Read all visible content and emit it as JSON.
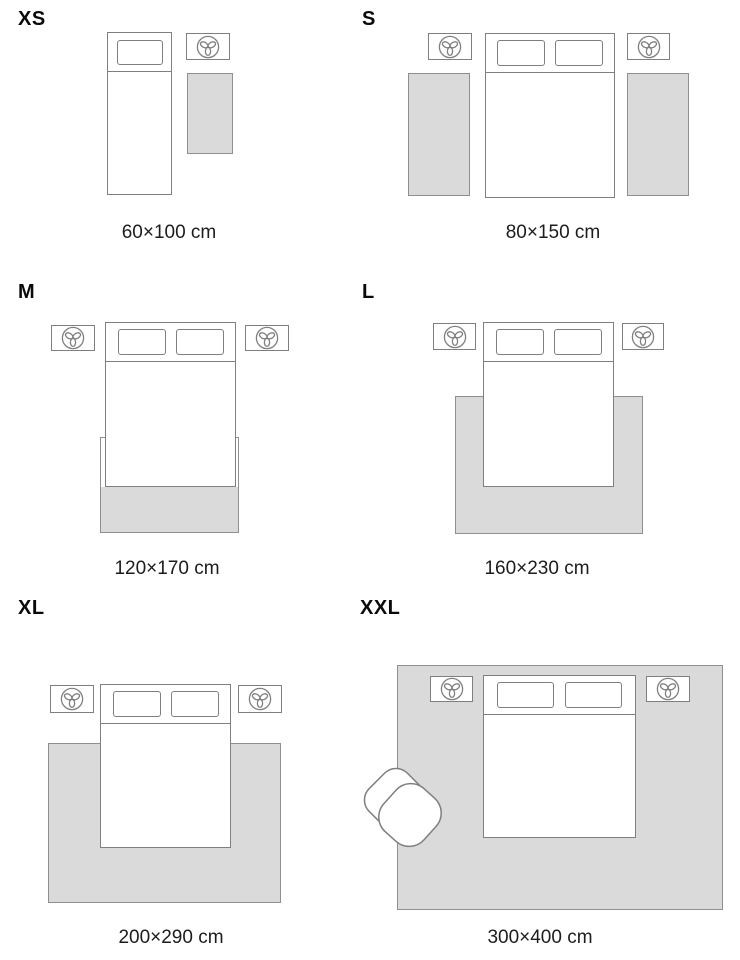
{
  "colors": {
    "background": "#ffffff",
    "rug_fill": "#dadada",
    "rug_border": "#8f8f8f",
    "furniture_outline": "#7f7f7f",
    "size_label_text": "#0a0a0a",
    "dimension_text": "#1c1c1e"
  },
  "icons": {
    "nightstand_icon": "plant-icon",
    "armchair_icon": "armchair"
  },
  "panels": [
    {
      "id": "xs",
      "size_label": "XS",
      "dimension_label": "60×100 cm",
      "beds": 1,
      "pillows": 1,
      "nightstands": 1,
      "rugs": 1
    },
    {
      "id": "s",
      "size_label": "S",
      "dimension_label": "80×150 cm",
      "beds": 1,
      "pillows": 2,
      "nightstands": 2,
      "rugs": 2
    },
    {
      "id": "m",
      "size_label": "M",
      "dimension_label": "120×170 cm",
      "beds": 1,
      "pillows": 2,
      "nightstands": 2,
      "rugs": 1
    },
    {
      "id": "l",
      "size_label": "L",
      "dimension_label": "160×230 cm",
      "beds": 1,
      "pillows": 2,
      "nightstands": 2,
      "rugs": 1
    },
    {
      "id": "xl",
      "size_label": "XL",
      "dimension_label": "200×290 cm",
      "beds": 1,
      "pillows": 2,
      "nightstands": 2,
      "rugs": 1
    },
    {
      "id": "xxl",
      "size_label": "XXL",
      "dimension_label": "300×400 cm",
      "beds": 1,
      "pillows": 2,
      "nightstands": 2,
      "rugs": 1,
      "armchairs": 1
    }
  ]
}
